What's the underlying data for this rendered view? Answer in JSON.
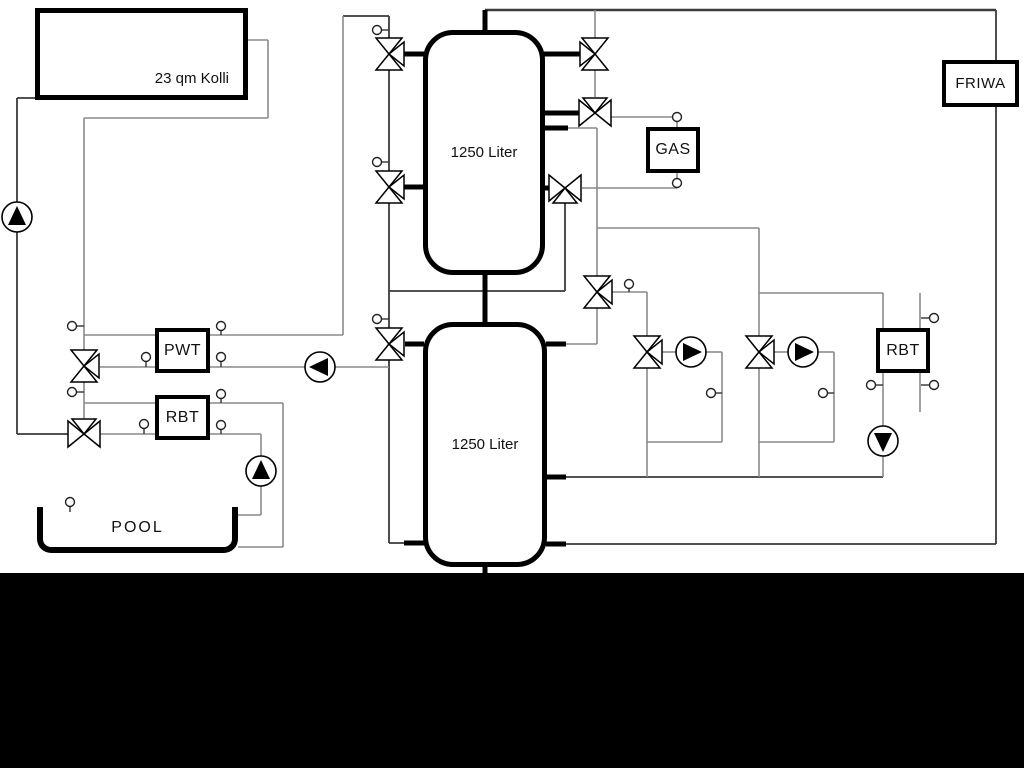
{
  "diagram": {
    "title_context": "hydraulic-scheme",
    "collector": {
      "label": "23 qm Kolli"
    },
    "tank1": {
      "label": "1250 Liter"
    },
    "tank2": {
      "label": "1250 Liter"
    },
    "gas": {
      "label": "GAS"
    },
    "pwt": {
      "label": "PWT"
    },
    "rbt_left": {
      "label": "RBT"
    },
    "rbt_right": {
      "label": "RBT"
    },
    "friwa": {
      "label": "FRIWA"
    },
    "pool": {
      "label": "POOL"
    },
    "symbols": {
      "pump_icon": "circle-with-filled-triangle",
      "three_way_valve_icon": "three-hollow-triangles-meeting-at-center",
      "sensor_icon": "small-circle-with-stem"
    },
    "colors": {
      "pipe_gray": "#8a8a8a",
      "pipe_dark": "#3a3a3a",
      "component_black": "#000000",
      "background": "#ffffff",
      "footer_band": "#000000"
    }
  }
}
